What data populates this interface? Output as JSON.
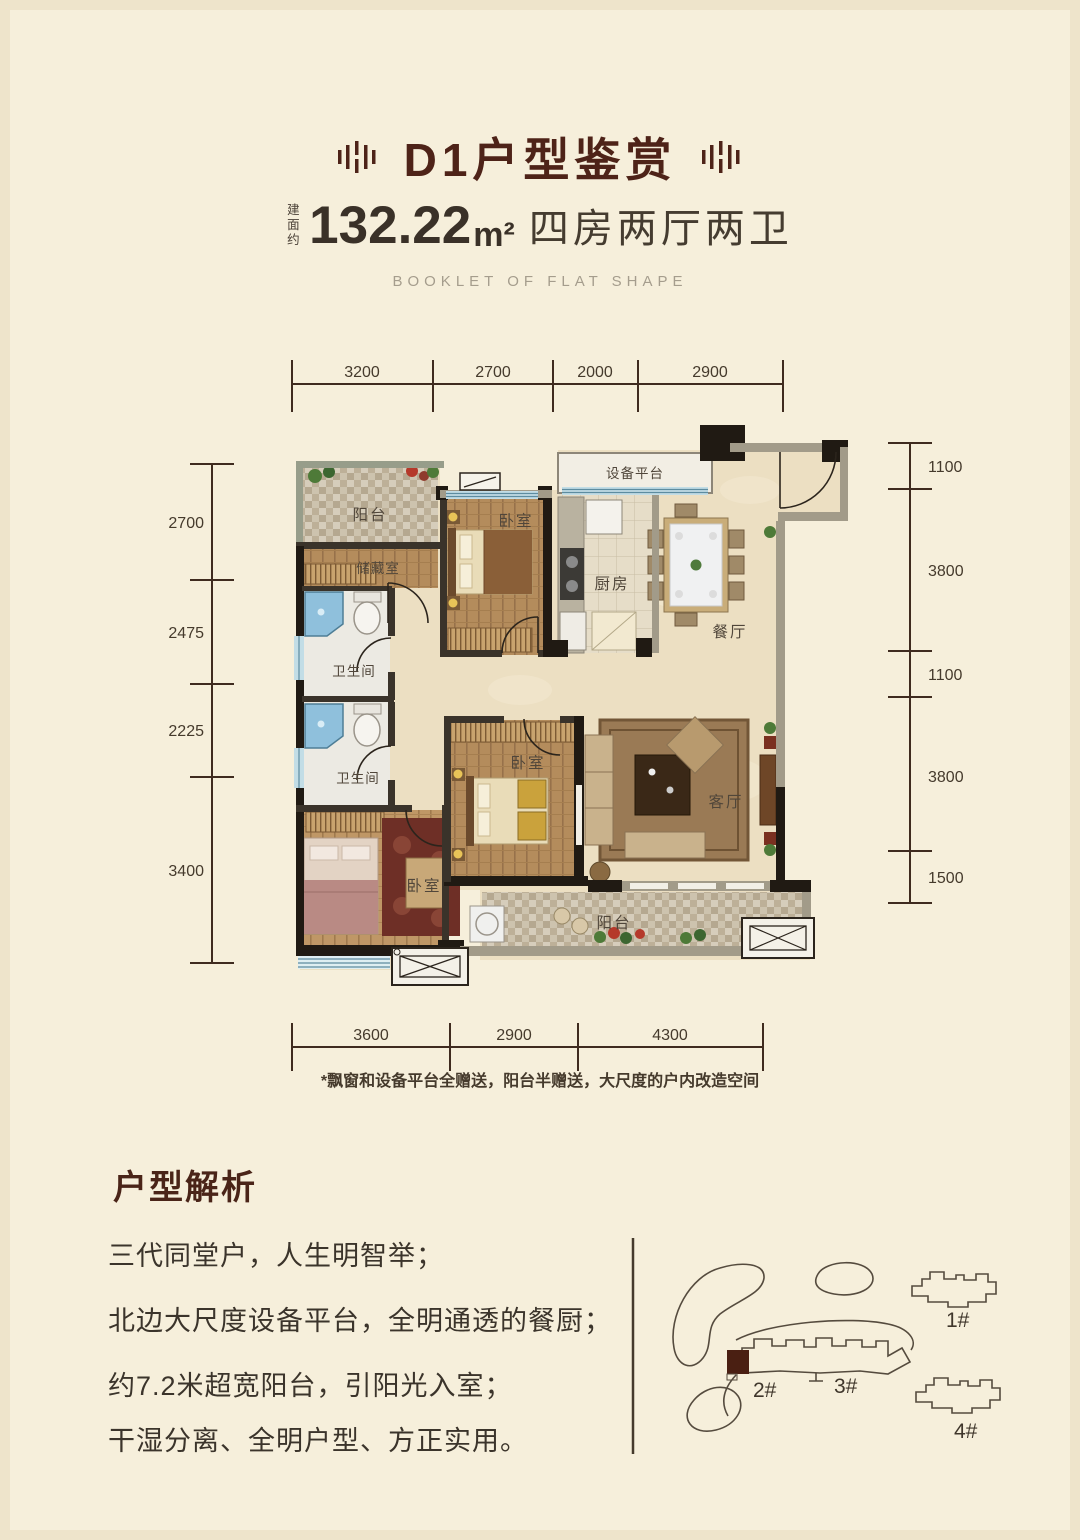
{
  "header": {
    "title": "D1户型鉴赏",
    "area_prefix": "建面约",
    "area_value": "132.22",
    "area_unit": "m²",
    "layout_text": "四房两厅两卫",
    "subtitle_en": "BOOKLET OF FLAT SHAPE"
  },
  "plan": {
    "dims_top": [
      "3200",
      "2700",
      "2000",
      "2900"
    ],
    "dims_left": [
      "2700",
      "2475",
      "2225",
      "3400"
    ],
    "dims_right": [
      "1100",
      "3800",
      "1100",
      "3800",
      "1500"
    ],
    "dims_bottom": [
      "3600",
      "2900",
      "4300"
    ],
    "rooms": {
      "balcony_north": "阳台",
      "storage": "储藏室",
      "bath_1": "卫生间",
      "bath_2": "卫生间",
      "bedroom_north": "卧室",
      "bedroom_middle": "卧室",
      "bedroom_southwest": "卧室",
      "kitchen": "厨房",
      "dining": "餐厅",
      "living": "客厅",
      "equipment_platform": "设备平台",
      "balcony_south": "阳台"
    },
    "note": "*飘窗和设备平台全赠送，阳台半赠送，大尺度的户内改造空间"
  },
  "analysis": {
    "heading": "户型解析",
    "points": [
      "三代同堂户，人生明智举；",
      "北边大尺度设备平台，全明通透的餐厨；",
      "约7.2米超宽阳台，引阳光入室；",
      "干湿分离、全明户型、方正实用。"
    ]
  },
  "siteplan": {
    "building_1": "1#",
    "building_2": "2#",
    "building_3": "3#",
    "building_4": "4#"
  },
  "colors": {
    "background": "#f6efdb",
    "accent_brown": "#4e2318",
    "text_dark": "#3b342b",
    "text_muted": "#a59d8d",
    "dim_line": "#3f2b1f",
    "highlight_unit": "#4a1f12"
  }
}
